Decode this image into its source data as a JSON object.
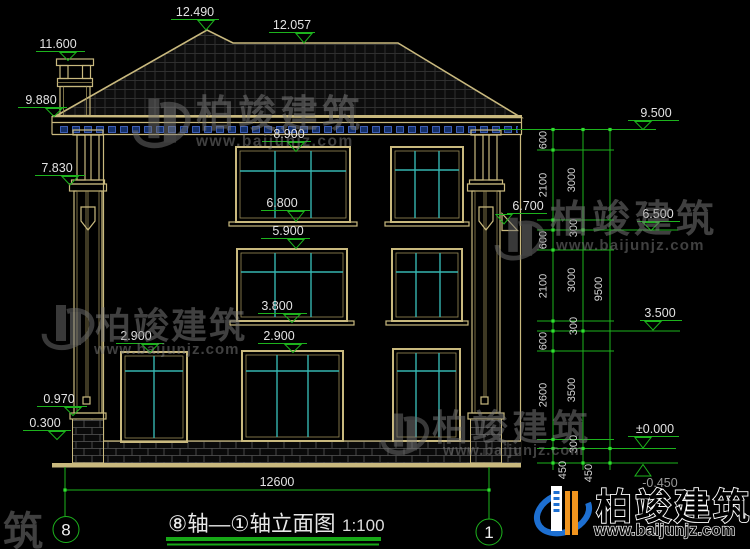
{
  "title": {
    "name": "⑧轴—①轴立面图",
    "scale": "1:100"
  },
  "axes": {
    "left": "8",
    "right": "1"
  },
  "overall_dim": "12600",
  "marks": {
    "m12490": "12.490",
    "m12057": "12.057",
    "m11600": "11.600",
    "m9880": "9.880",
    "m7830": "7.830",
    "m0970": "0.970",
    "m0300": "0.300",
    "m8900": "8.900",
    "m6800": "6.800",
    "m5900": "5.900",
    "m3800": "3.800",
    "m2900a": "2.900",
    "m2900b": "2.900",
    "m9500": "9.500",
    "m6700": "6.700",
    "m6500": "6.500",
    "m3500": "3.500",
    "m0000": "±0.000",
    "mn0450": "-0.450"
  },
  "chains": {
    "c1": [
      "600",
      "2100",
      "300",
      "600",
      "2100",
      "300",
      "600",
      "2600",
      "300",
      "450"
    ],
    "c2": [
      "3000",
      "3000",
      "3500",
      "450"
    ],
    "c3": [
      "9500"
    ]
  },
  "watermark": {
    "brand": "柏竣建筑",
    "url": "www.baijunjz.com"
  },
  "logo": {
    "brand": "柏竣建筑",
    "url": "www.baijunjz.com"
  },
  "colors": {
    "background": "#000000",
    "building_line": "#c9b97e",
    "dimension_green": "#1db31d",
    "glass_teal": "#35b5b0",
    "dentil_blue": "#4a6fd4",
    "logo_blue": "#1d6fd1",
    "logo_orange": "#f0941e"
  }
}
